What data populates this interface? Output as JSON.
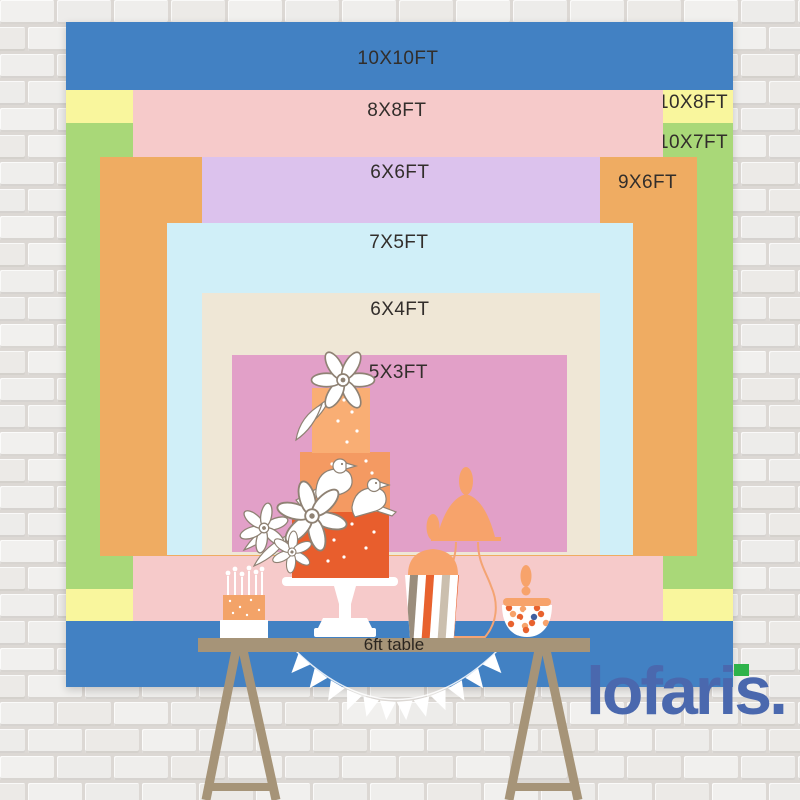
{
  "backdrop": {
    "layers": [
      {
        "id": "10x10",
        "label": "10X10FT",
        "color": "#4281c3"
      },
      {
        "id": "10x8",
        "label": "10X8FT",
        "color": "#f9f69d"
      },
      {
        "id": "10x7",
        "label": "10X7FT",
        "color": "#a9d878"
      },
      {
        "id": "8x8",
        "label": "8X8FT",
        "color": "#f6caca"
      },
      {
        "id": "9x6",
        "label": "9X6FT",
        "color": "#efac62"
      },
      {
        "id": "6x6",
        "label": "6X6FT",
        "color": "#dcc2ed"
      },
      {
        "id": "7x5",
        "label": "7X5FT",
        "color": "#d0eff8"
      },
      {
        "id": "6x4",
        "label": "6X4FT",
        "color": "#efe7d6"
      },
      {
        "id": "5x3",
        "label": "5X3FT",
        "color": "#e2a0c8"
      }
    ]
  },
  "table": {
    "label": "6ft table",
    "color": "#a69478"
  },
  "brand": {
    "wordmark": "lofaris",
    "period": "."
  },
  "palette": {
    "label-ink": "#322e2b",
    "table-ink": "#2b2620",
    "table-tan": "#a69478",
    "logo-blue": "#4a68ae",
    "logo-green": "#2eb34b",
    "outline": "#8f8274",
    "cake-top": "#f9ae74",
    "cake-mid": "#f49a62",
    "cake-bottom": "#e85e2d",
    "peach": "#f7a36b",
    "speckle-orange": "#f3a368",
    "stripe-orange": "#e8622e",
    "stripe-gray": "#9a8d7c",
    "stripe-cream": "#cbbfae",
    "candy-blue": "#3f5fa0"
  }
}
